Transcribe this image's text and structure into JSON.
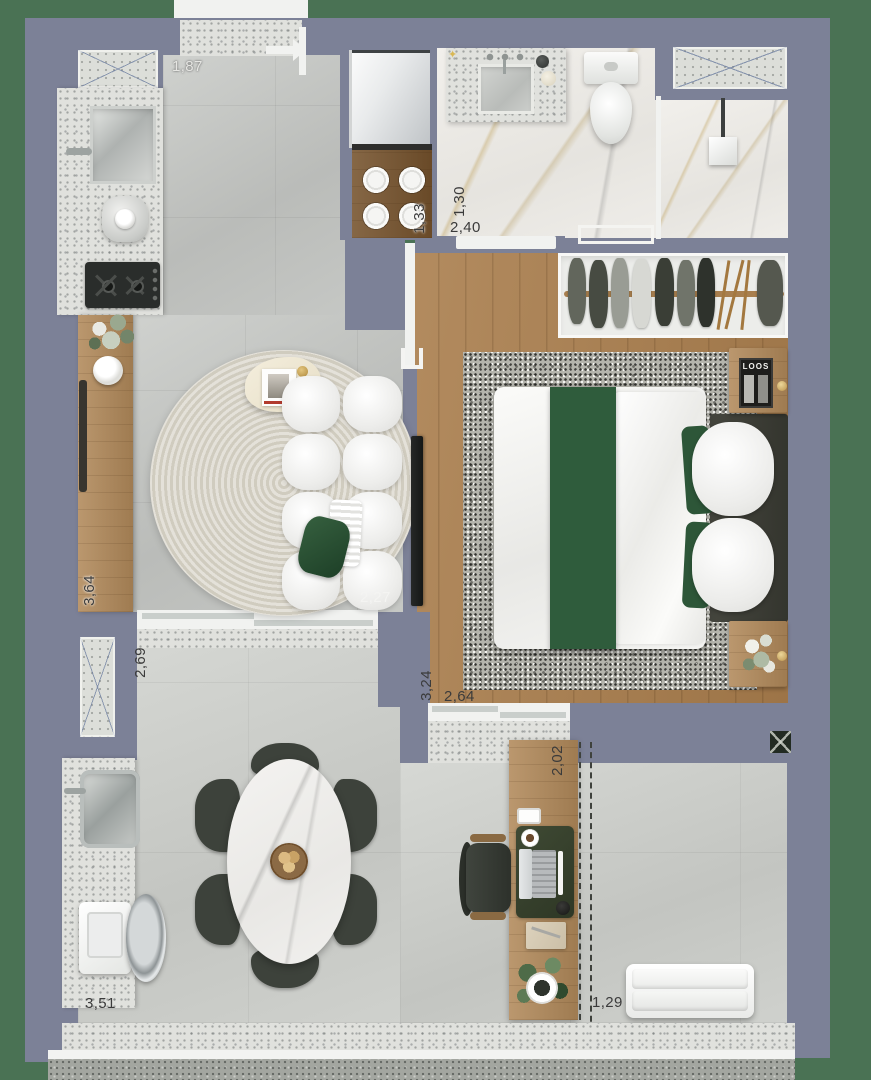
{
  "plan_title": "apartment-floor-plan",
  "colors": {
    "background_green": "#4a7254",
    "wall_slate": "#7c8197",
    "wood_floor": "#aa7e4d",
    "accent_green": "#2f5c3c",
    "tile_gray": "#c3c5c2",
    "terrazzo": "#e0e1dd",
    "marble": "#edebe6",
    "label_dark": "#3b3b3b",
    "gold": "#d0a452"
  },
  "labels": {
    "entry_width": "1,87",
    "stove_width": "1,33",
    "bathroom_width": "1,30",
    "bathroom_length": "2,40",
    "kitchen_wall_length": "3,64",
    "sofa_width": "2,27",
    "terrace_width": "2,69",
    "bedroom_width": "3,24",
    "bedroom_length": "2,64",
    "desk_length": "2,02",
    "terrace_length": "3,51",
    "walkway_width": "1,29"
  },
  "bedroom": {
    "magazine_title": "LOOS"
  },
  "icons": {
    "sparkle": "✦",
    "entry_door": "arrow-right-door",
    "door_swing": "u-bracket",
    "column_marker": "x-square",
    "shower_head": "square-shower"
  }
}
